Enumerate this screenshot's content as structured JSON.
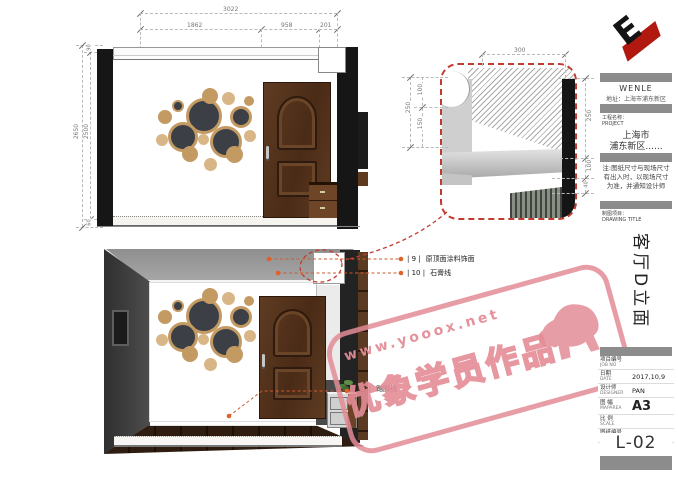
{
  "top_view": {
    "dim_total": "3022",
    "dim_seg1": "1862",
    "dim_seg2": "958",
    "dim_seg3": "201",
    "dim_h_outer": "2650",
    "dim_h_inner": "2500",
    "dim_h_top": "90",
    "dim_h_bottom": "60"
  },
  "detail_view": {
    "dim_top": "300",
    "dim_left_outer": "250",
    "dim_left_upper": "100",
    "dim_left_lower": "150",
    "dim_right_upper": "250",
    "dim_right_mid": "100",
    "dim_right_lower": "40"
  },
  "annotations": {
    "a9_num": "| 9 |",
    "a9_label": "原顶面涂料饰面",
    "a10_num": "| 10 |",
    "a10_label": "石膏线",
    "a36_num": "| 36 |",
    "a36_label": "踢脚线"
  },
  "watermark": {
    "url": "www.yooox.net",
    "text": "优象学员作品"
  },
  "titleblock": {
    "logo_letter": "E",
    "company": "WENLE",
    "address": "地址：上海市浦东新区",
    "project_label_cn": "工程名称：",
    "project_label_en": "PROJECT",
    "project_line1": "上海市",
    "project_line2": "浦东新区......",
    "note": "注:图纸尺寸与现场尺寸有出入时，以现场尺寸为准，并通知设计师",
    "drawing_label_cn": "制图项目：",
    "drawing_label_en": "DRAWING TITLE",
    "drawing_title": "客厅D立面",
    "rows": [
      {
        "cn": "项目编号",
        "en": "JOB NO",
        "value": ""
      },
      {
        "cn": "日期",
        "en": "DATE",
        "value": "2017,10,9"
      },
      {
        "cn": "设计师",
        "en": "DESIGNER",
        "value": "PAN"
      },
      {
        "cn": "图 幅",
        "en": "MAPAREA",
        "value": "A3"
      },
      {
        "cn": "比 例",
        "en": "SCALE",
        "value": ""
      },
      {
        "cn": "图纸编号",
        "en": "DWG NO",
        "value": ""
      }
    ],
    "sheet_no": "L-02"
  }
}
